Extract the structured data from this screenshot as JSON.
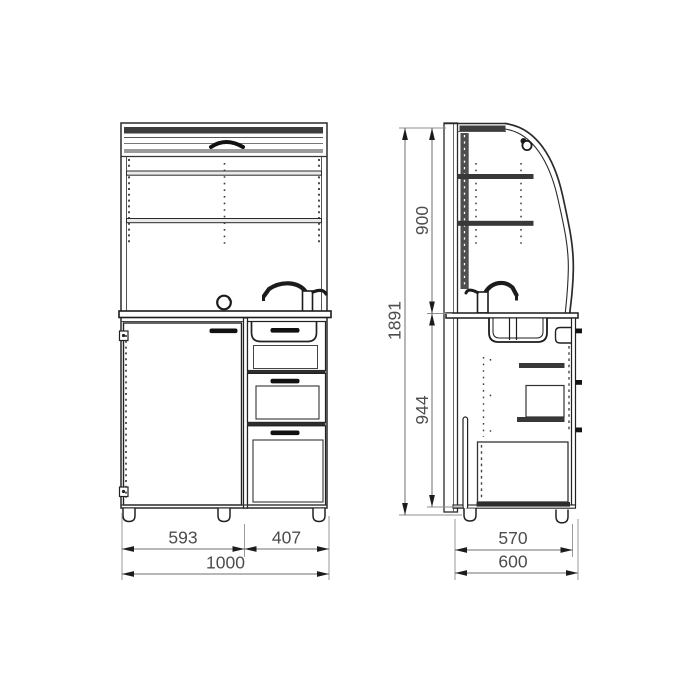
{
  "drawing": {
    "kind": "furniture technical drawing - roller shutter cabinet, front and side views",
    "background": "#ffffff",
    "line_color": "#2a2a2a",
    "dim_line_color": "#6f6f6f",
    "dim_text_color": "#4d4d4d",
    "dimensions": {
      "front_left_mm": "593",
      "front_right_mm": "407",
      "front_total_mm": "1000",
      "height_upper_mm": "900",
      "height_total_mm": "1891",
      "height_base_mm": "944",
      "depth_inner_mm": "570",
      "depth_total_mm": "600"
    }
  }
}
